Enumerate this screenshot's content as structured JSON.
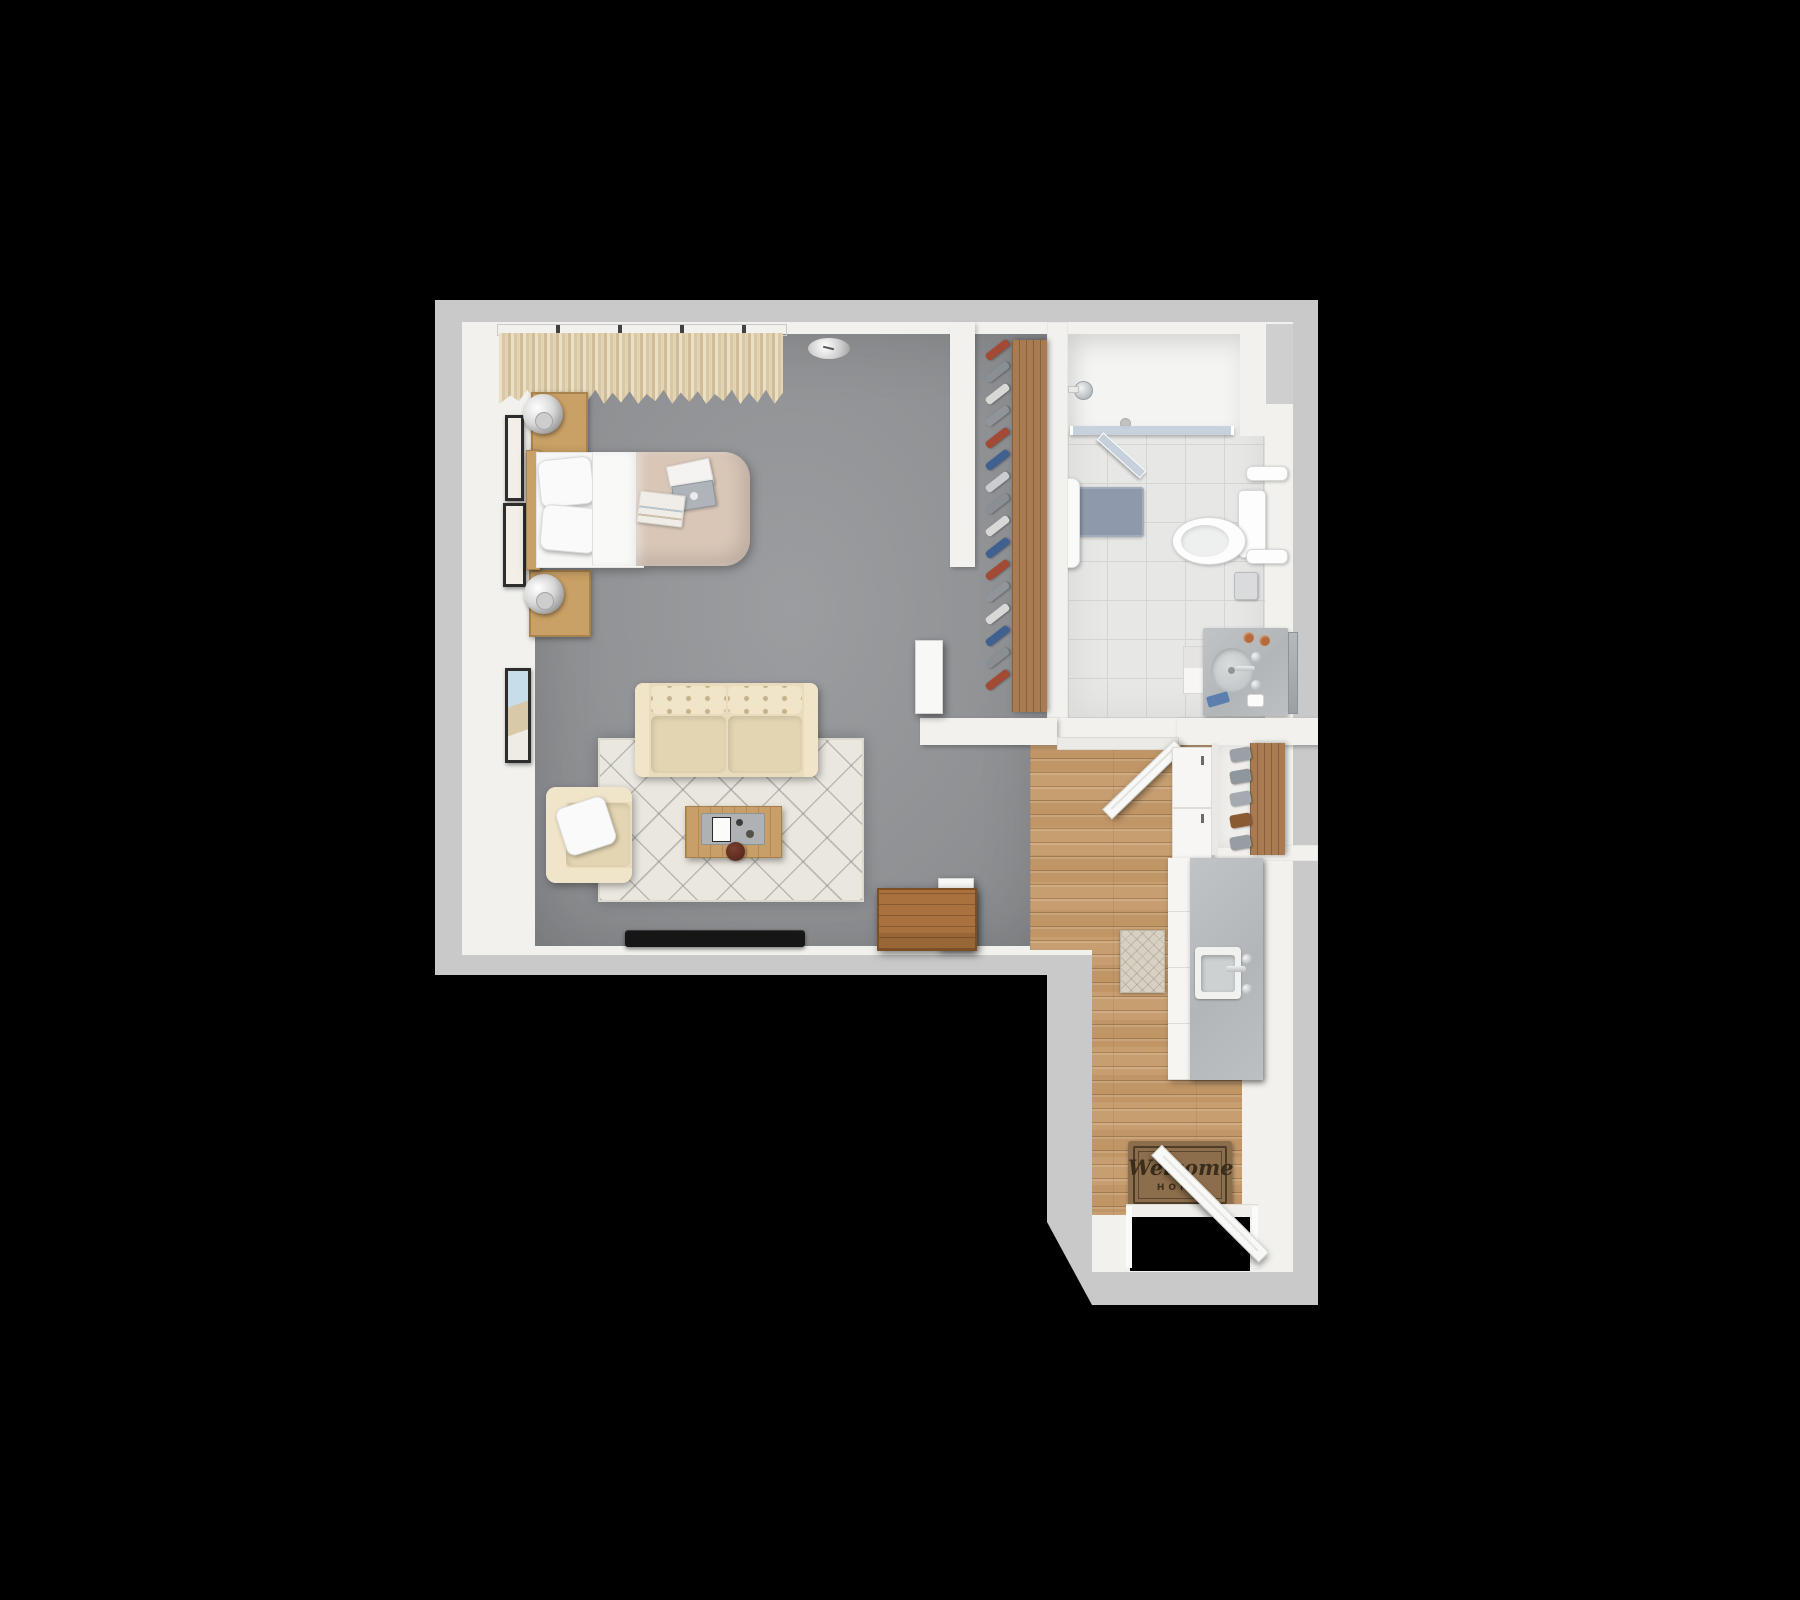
{
  "scene": {
    "type": "3d-floor-plan-top-view",
    "subject": "studio apartment with bathroom, walk-in closet and entry kitchenette",
    "background": "#000000"
  },
  "palette": {
    "background": "#000000",
    "outer_wall": "#c9c9c9",
    "inner_wall": "#f2f1ed",
    "carpet": "#919396",
    "wood": "#c79e70",
    "tile": "#e7e7e6",
    "shower_floor": "#f4f4f2",
    "shelf_wood": "#a87c50",
    "upholstery": "#e8dcbd",
    "duvet": "#d9c6b7",
    "pillow_white": "#fafafa",
    "rug": "#eae7df",
    "chest": "#a9713d",
    "nightstand_wood": "#c9a065",
    "coffee_table_wood": "#c89f68",
    "tray_gray": "#aeb2b5",
    "tv_black": "#161616",
    "bath_mat": "#8e9aab",
    "counter_gray": "#b9bdbe",
    "cabinet_white": "#f7f6f4",
    "mat_brown": "#8d6e4c",
    "mat_text": "#3b2d1c",
    "glass_blue": "#c3cfdb",
    "door_white": "#f8f8f6",
    "bowl_red": "#5a2b1d",
    "towel_blue": "#5b7fae",
    "copper": "#b66a3a"
  },
  "rooms": [
    {
      "name": "living-bedroom",
      "floor": "gray carpet"
    },
    {
      "name": "walk-in-closet",
      "floor": "gray carpet with wood shelf"
    },
    {
      "name": "bathroom",
      "floor": "light gray tile"
    },
    {
      "name": "entry-kitchen-hall",
      "floor": "oak plank"
    }
  ],
  "entry": {
    "welcome_mat": {
      "line1": "Welcome",
      "line2": "HOME"
    }
  },
  "closet": {
    "clothes_colors": [
      "#a34a35",
      "#8a8f96",
      "#d8d8d6",
      "#90959b",
      "#a34a35",
      "#40618f",
      "#c9cdd1",
      "#8a8f96",
      "#d8d8d6",
      "#40618f",
      "#a34a35",
      "#90959b",
      "#d8d8d6",
      "#40618f",
      "#8a8f96",
      "#a34a35"
    ]
  },
  "hall_closet": {
    "item_colors": [
      "#9aa0a6",
      "#8f969c",
      "#a4aab0",
      "#8a5a33",
      "#979da3"
    ]
  },
  "furniture": {
    "living_bedroom": [
      "twin-bed",
      "white-pillows",
      "folded-sheet",
      "beige-duvet",
      "headboard",
      "nightstand-upper",
      "nightstand-lower",
      "table-lamp-upper",
      "table-lamp-lower",
      "wall-frame-1",
      "wall-frame-2",
      "wall-frame-3",
      "window-curtains",
      "curtain-rod",
      "ceiling-light",
      "loveseat-sofa",
      "armchair",
      "throw-pillow",
      "area-rug",
      "coffee-table",
      "serving-tray",
      "decor-bowl",
      "flat-tv",
      "storage-chest",
      "parked-door"
    ],
    "walk_in_closet": [
      "closet-shelf",
      "hanging-clothes",
      "closet-door"
    ],
    "bathroom": [
      "walk-in-shower",
      "shower-glass-panel",
      "shower-glass-door",
      "shower-head",
      "shower-drain",
      "bath-mat",
      "hanging-towel",
      "toilet",
      "towel-bar-upper",
      "towel-bar-lower",
      "toilet-paper-holder",
      "vanity-counter",
      "vanity-drawers",
      "round-sink",
      "faucet",
      "copper-cups",
      "blue-towel",
      "soap-dispenser",
      "mirror"
    ],
    "entry_kitchen": [
      "bathroom-door",
      "entry-door",
      "welcome-mat",
      "kitchen-mat",
      "kitchen-counter",
      "kitchen-sink",
      "kitchen-faucet",
      "tall-cabinet",
      "hall-closet-shelf",
      "hall-closet-items"
    ]
  }
}
